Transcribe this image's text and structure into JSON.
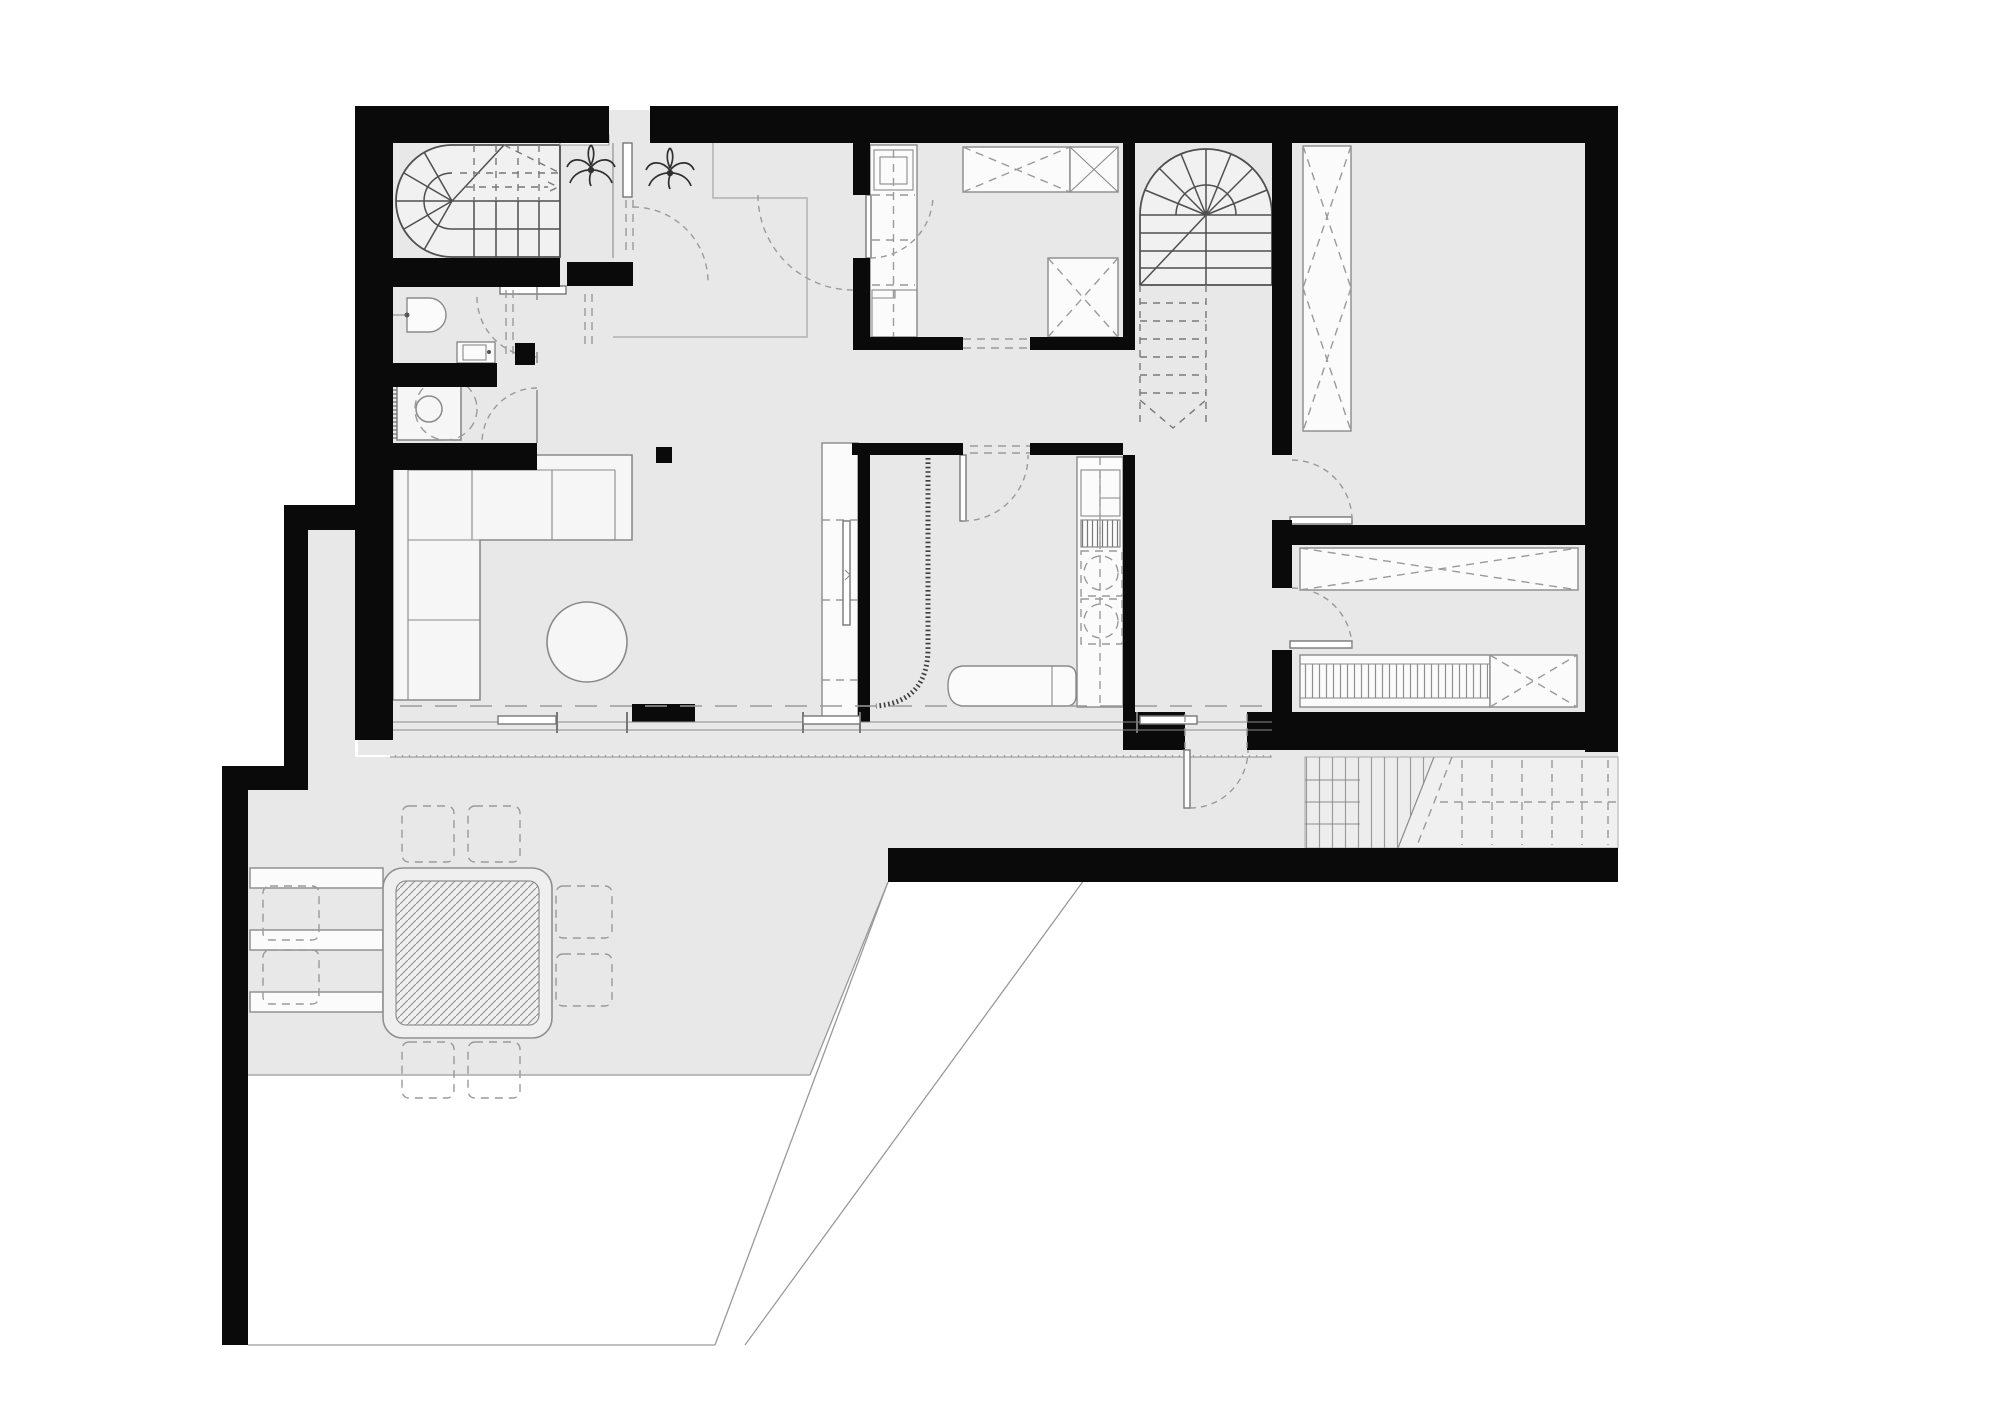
{
  "document": {
    "type": "architectural-floor-plan",
    "visible_text": [],
    "sheet_background": "#ffffff"
  },
  "colors": {
    "wall": "#0a0a0a",
    "floor": "#e8e8e8",
    "line": "#8a8a8a",
    "dash": "#9a9a9a",
    "stair_line": "#4f4f4f",
    "furniture_fill": "#f6f6f6",
    "furniture_white": "#fbfbfb",
    "decking_fill": "#f3f3f3",
    "background": "#ffffff"
  },
  "plan": {
    "rooms": [
      {
        "name": "stair-room"
      },
      {
        "name": "vestibule"
      },
      {
        "name": "wc"
      },
      {
        "name": "utility-room"
      },
      {
        "name": "living-room"
      },
      {
        "name": "entry-hall"
      },
      {
        "name": "laundry-room"
      },
      {
        "name": "stair-hall"
      },
      {
        "name": "shower-room"
      },
      {
        "name": "kitchen"
      },
      {
        "name": "corridor"
      },
      {
        "name": "bedroom-north"
      },
      {
        "name": "bedroom-south"
      },
      {
        "name": "terrace"
      },
      {
        "name": "lower-terrace"
      },
      {
        "name": "garden"
      }
    ],
    "stairs": [
      {
        "name": "winder-stair-west",
        "form": "u-shaped-winder"
      },
      {
        "name": "main-stair-east",
        "form": "u-shaped-winder-with-dashed-lower-flight"
      },
      {
        "name": "exterior-steps"
      },
      {
        "name": "exterior-ramp"
      }
    ],
    "fixtures": [
      {
        "name": "entrance-door"
      },
      {
        "name": "potted-plant",
        "count": 2
      },
      {
        "name": "toilet"
      },
      {
        "name": "washbasin"
      },
      {
        "name": "washing-machine"
      },
      {
        "name": "corner-sofa"
      },
      {
        "name": "coffee-table"
      },
      {
        "name": "laundry-appliance-column"
      },
      {
        "name": "storage-cabinet-dashed-x",
        "count": 4
      },
      {
        "name": "storage-cabinet-solid-x",
        "count": 3
      },
      {
        "name": "tall-cabinet"
      },
      {
        "name": "shower-curtain"
      },
      {
        "name": "daybed"
      },
      {
        "name": "kitchen-unit"
      },
      {
        "name": "wardrobe-tall"
      },
      {
        "name": "wardrobe-long"
      },
      {
        "name": "slatted-bench"
      },
      {
        "name": "floor-drain",
        "count": 2
      },
      {
        "name": "outdoor-table"
      },
      {
        "name": "outdoor-chair",
        "count": 6
      },
      {
        "name": "outdoor-bench",
        "count": 3
      },
      {
        "name": "sliding-glass-doors"
      },
      {
        "name": "door-swing",
        "count": 9
      }
    ]
  }
}
